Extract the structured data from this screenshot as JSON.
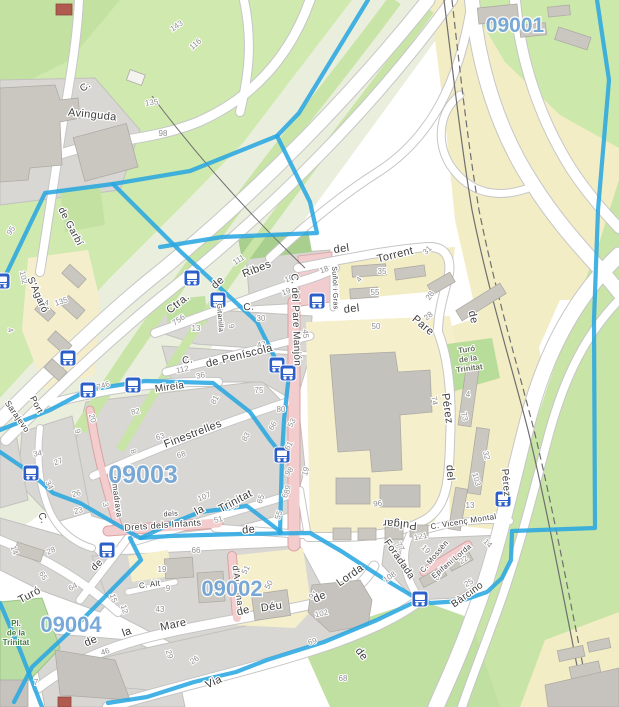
{
  "map": {
    "type": "openstreetmap-city-map",
    "area": "Trinitat Vella / Trinitat Nova (Barcelona)"
  },
  "colors": {
    "boundary": "#2aa7e0",
    "zone_label": "#74a6d6",
    "bus_icon": "#2c5fc8",
    "park_green": "#cfe9ae",
    "band_green": "#c8e4a6",
    "beige": "#f3edc5",
    "school_yellow": "#f6efcb",
    "block_gray": "#d8d7d3",
    "building_gray": "#cac7c1",
    "pink_road": "#f3cdcd",
    "street_text": "#3d3d3d",
    "housenumber_text": "#8e8e8e"
  },
  "zones": [
    {
      "label": "09001",
      "x": 515,
      "y": 32,
      "size": 21
    },
    {
      "label": "09003",
      "x": 143,
      "y": 483,
      "size": 25
    },
    {
      "label": "09002",
      "x": 232,
      "y": 596,
      "size": 22
    },
    {
      "label": "09004",
      "x": 71,
      "y": 632,
      "size": 22
    }
  ],
  "streets": [
    {
      "t": "Avinguda",
      "x": 92,
      "y": 118,
      "r": 6,
      "s": 11
    },
    {
      "t": "C.",
      "x": 87,
      "y": 89,
      "r": -35,
      "s": 10
    },
    {
      "t": "de Garbí",
      "x": 68,
      "y": 228,
      "r": 62,
      "s": 10
    },
    {
      "t": "S'Agaró",
      "x": 35,
      "y": 296,
      "r": 66,
      "s": 10
    },
    {
      "t": "Port",
      "x": 34,
      "y": 406,
      "r": 62,
      "s": 9
    },
    {
      "t": "Sarajevo",
      "x": 15,
      "y": 418,
      "r": 55,
      "s": 8.5
    },
    {
      "t": "Ctra.",
      "x": 180,
      "y": 306,
      "r": -38,
      "s": 11
    },
    {
      "t": "de",
      "x": 220,
      "y": 285,
      "r": -42,
      "s": 11
    },
    {
      "t": "Ribes",
      "x": 258,
      "y": 272,
      "r": -22,
      "s": 11
    },
    {
      "t": "del",
      "x": 342,
      "y": 252,
      "r": -8,
      "s": 11
    },
    {
      "t": "Torrent",
      "x": 396,
      "y": 258,
      "r": -14,
      "s": 11
    },
    {
      "t": "C.",
      "x": 249,
      "y": 310,
      "r": -4,
      "s": 10
    },
    {
      "t": "del",
      "x": 352,
      "y": 312,
      "r": -6,
      "s": 11
    },
    {
      "t": "Pare",
      "x": 421,
      "y": 328,
      "r": 40,
      "s": 11
    },
    {
      "t": "de",
      "x": 470,
      "y": 318,
      "r": 76,
      "s": 11
    },
    {
      "t": "Suñol i Gras",
      "x": 333,
      "y": 288,
      "r": 88,
      "s": 7
    },
    {
      "t": "Gitanilla",
      "x": 218,
      "y": 318,
      "r": 86,
      "s": 7
    },
    {
      "t": "de Peníscola",
      "x": 240,
      "y": 359,
      "r": -14,
      "s": 11
    },
    {
      "t": "C.",
      "x": 188,
      "y": 363,
      "r": -8,
      "s": 10
    },
    {
      "t": "Mireia",
      "x": 170,
      "y": 390,
      "r": -8,
      "s": 10
    },
    {
      "t": "Finestrelles",
      "x": 194,
      "y": 437,
      "r": -21,
      "s": 11
    },
    {
      "t": "C. del Pare Manjón",
      "x": 293,
      "y": 320,
      "r": 88,
      "s": 10
    },
    {
      "t": "Pérez",
      "x": 444,
      "y": 409,
      "r": 82,
      "s": 11
    },
    {
      "t": "del",
      "x": 447,
      "y": 473,
      "r": 86,
      "s": 11
    },
    {
      "t": "Pulgar",
      "x": 400,
      "y": 521,
      "r": 185,
      "s": 11
    },
    {
      "t": "Pérez",
      "x": 503,
      "y": 483,
      "r": 85,
      "s": 10
    },
    {
      "t": "la",
      "x": 201,
      "y": 513,
      "r": -28,
      "s": 11
    },
    {
      "t": "Trinitat",
      "x": 237,
      "y": 504,
      "r": -28,
      "s": 11
    },
    {
      "t": "C.",
      "x": 40,
      "y": 519,
      "r": 70,
      "s": 10
    },
    {
      "t": "Almadrava",
      "x": 114,
      "y": 497,
      "r": 82,
      "s": 8
    },
    {
      "t": "Turó",
      "x": 31,
      "y": 598,
      "r": -28,
      "s": 11
    },
    {
      "t": "de",
      "x": 99,
      "y": 567,
      "r": -45,
      "s": 10
    },
    {
      "t": "de",
      "x": 92,
      "y": 644,
      "r": -22,
      "s": 11
    },
    {
      "t": "la",
      "x": 128,
      "y": 635,
      "r": -20,
      "s": 11
    },
    {
      "t": "Mare",
      "x": 174,
      "y": 628,
      "r": -12,
      "s": 11
    },
    {
      "t": "de",
      "x": 244,
      "y": 614,
      "r": -15,
      "s": 11
    },
    {
      "t": "Déu",
      "x": 272,
      "y": 610,
      "r": -8,
      "s": 11
    },
    {
      "t": "de",
      "x": 321,
      "y": 600,
      "r": -25,
      "s": 11
    },
    {
      "t": "Lorda",
      "x": 352,
      "y": 578,
      "r": -35,
      "s": 11
    },
    {
      "t": "Foradada",
      "x": 397,
      "y": 561,
      "r": 55,
      "s": 10
    },
    {
      "t": "d'Ausona",
      "x": 235,
      "y": 586,
      "r": 83,
      "s": 9
    },
    {
      "t": "Drets dels Infants",
      "x": 163,
      "y": 528,
      "r": -4,
      "s": 9
    },
    {
      "t": "dels",
      "x": 171,
      "y": 516,
      "r": -4,
      "s": 7
    },
    {
      "t": "C. Alt",
      "x": 150,
      "y": 587,
      "r": -8,
      "s": 8
    },
    {
      "t": "de",
      "x": 249,
      "y": 533,
      "r": -6,
      "s": 11
    },
    {
      "t": "de",
      "x": 359,
      "y": 656,
      "r": 52,
      "s": 11
    },
    {
      "t": "Via",
      "x": 215,
      "y": 685,
      "r": -24,
      "s": 11
    },
    {
      "t": "C. Vicenç Montal",
      "x": 464,
      "y": 524,
      "r": -9,
      "s": 8
    },
    {
      "t": "C. Mossèn",
      "x": 436,
      "y": 558,
      "r": -50,
      "s": 7.5
    },
    {
      "t": "Epifani Lorda",
      "x": 453,
      "y": 563,
      "r": -40,
      "s": 7.5
    },
    {
      "t": "Bàrcino",
      "x": 469,
      "y": 597,
      "r": -36,
      "s": 10
    }
  ],
  "house_numbers": [
    {
      "t": "143",
      "x": 178,
      "y": 28,
      "r": -35
    },
    {
      "t": "116",
      "x": 197,
      "y": 46,
      "r": -40
    },
    {
      "t": "135",
      "x": 152,
      "y": 105,
      "r": -8
    },
    {
      "t": "98",
      "x": 163,
      "y": 136,
      "r": 0
    },
    {
      "t": "95",
      "x": 13,
      "y": 232,
      "r": -55
    },
    {
      "t": "102",
      "x": 21,
      "y": 278,
      "r": 78
    },
    {
      "t": "54",
      "x": 44,
      "y": 305,
      "r": 8
    },
    {
      "t": "135",
      "x": 62,
      "y": 304,
      "r": -18
    },
    {
      "t": "4",
      "x": 8,
      "y": 331,
      "r": 70
    },
    {
      "t": "111",
      "x": 240,
      "y": 262,
      "r": -32
    },
    {
      "t": "16",
      "x": 290,
      "y": 281,
      "r": -22
    },
    {
      "t": "19",
      "x": 287,
      "y": 294,
      "r": -22
    },
    {
      "t": "30",
      "x": 261,
      "y": 321,
      "r": 0
    },
    {
      "t": "9",
      "x": 229,
      "y": 327,
      "r": 72
    },
    {
      "t": "756",
      "x": 180,
      "y": 322,
      "r": -35
    },
    {
      "t": "13",
      "x": 196,
      "y": 331,
      "r": 0
    },
    {
      "t": "112",
      "x": 183,
      "y": 372,
      "r": -12
    },
    {
      "t": "36",
      "x": 201,
      "y": 378,
      "r": -12
    },
    {
      "t": "75",
      "x": 259,
      "y": 393,
      "r": 0
    },
    {
      "t": "18",
      "x": 325,
      "y": 272,
      "r": -20
    },
    {
      "t": "4",
      "x": 361,
      "y": 281,
      "r": -50
    },
    {
      "t": "35",
      "x": 382,
      "y": 274,
      "r": 0
    },
    {
      "t": "55",
      "x": 375,
      "y": 295,
      "r": 0
    },
    {
      "t": "28",
      "x": 432,
      "y": 297,
      "r": -55
    },
    {
      "t": "31",
      "x": 429,
      "y": 252,
      "r": -45
    },
    {
      "t": "50",
      "x": 376,
      "y": 329,
      "r": 0
    },
    {
      "t": "45",
      "x": 303,
      "y": 334,
      "r": 85
    },
    {
      "t": "43",
      "x": 262,
      "y": 347,
      "r": -12
    },
    {
      "t": "82",
      "x": 136,
      "y": 414,
      "r": -12
    },
    {
      "t": "746",
      "x": 104,
      "y": 388,
      "r": -18
    },
    {
      "t": "81",
      "x": 217,
      "y": 401,
      "r": -62
    },
    {
      "t": "80",
      "x": 281,
      "y": 412,
      "r": 0
    },
    {
      "t": "63",
      "x": 161,
      "y": 439,
      "r": -18
    },
    {
      "t": "68",
      "x": 182,
      "y": 457,
      "r": -18
    },
    {
      "t": "83",
      "x": 248,
      "y": 438,
      "r": -62
    },
    {
      "t": "66",
      "x": 275,
      "y": 427,
      "r": -62
    },
    {
      "t": "53",
      "x": 294,
      "y": 424,
      "r": -62
    },
    {
      "t": "61",
      "x": 291,
      "y": 447,
      "r": -62
    },
    {
      "t": "20",
      "x": 90,
      "y": 419,
      "r": 72
    },
    {
      "t": "9",
      "x": 75,
      "y": 432,
      "r": 72
    },
    {
      "t": "34",
      "x": 38,
      "y": 456,
      "r": -10
    },
    {
      "t": "27",
      "x": 59,
      "y": 464,
      "r": -20
    },
    {
      "t": "26",
      "x": 77,
      "y": 496,
      "r": -15
    },
    {
      "t": "23",
      "x": 79,
      "y": 513,
      "r": -15
    },
    {
      "t": "3",
      "x": 103,
      "y": 505,
      "r": 80
    },
    {
      "t": "8",
      "x": 131,
      "y": 452,
      "r": 75
    },
    {
      "t": "98",
      "x": 291,
      "y": 473,
      "r": -50
    },
    {
      "t": "19",
      "x": 308,
      "y": 472,
      "r": -75
    },
    {
      "t": "68",
      "x": 288,
      "y": 494,
      "r": -75
    },
    {
      "t": "65",
      "x": 263,
      "y": 500,
      "r": -70
    },
    {
      "t": "55",
      "x": 281,
      "y": 516,
      "r": -70
    },
    {
      "t": "89",
      "x": 290,
      "y": 490,
      "r": -80
    },
    {
      "t": "107",
      "x": 205,
      "y": 499,
      "r": -22
    },
    {
      "t": "90",
      "x": 235,
      "y": 508,
      "r": -22
    },
    {
      "t": "51",
      "x": 219,
      "y": 522,
      "r": -15
    },
    {
      "t": "66",
      "x": 196,
      "y": 553,
      "r": 0
    },
    {
      "t": "64",
      "x": 74,
      "y": 589,
      "r": -28
    },
    {
      "t": "65",
      "x": 41,
      "y": 577,
      "r": 60
    },
    {
      "t": "28",
      "x": 52,
      "y": 553,
      "r": -25
    },
    {
      "t": "14",
      "x": 12,
      "y": 551,
      "r": 70
    },
    {
      "t": "15",
      "x": 111,
      "y": 599,
      "r": 72
    },
    {
      "t": "12",
      "x": 122,
      "y": 610,
      "r": 72
    },
    {
      "t": "19",
      "x": 162,
      "y": 572,
      "r": 0
    },
    {
      "t": "9",
      "x": 168,
      "y": 591,
      "r": 0
    },
    {
      "t": "43",
      "x": 160,
      "y": 612,
      "r": 0
    },
    {
      "t": "46",
      "x": 106,
      "y": 654,
      "r": -20
    },
    {
      "t": "29",
      "x": 167,
      "y": 655,
      "r": 72
    },
    {
      "t": "26",
      "x": 196,
      "y": 662,
      "r": -35
    },
    {
      "t": "7",
      "x": 36,
      "y": 685,
      "r": 0
    },
    {
      "t": "34",
      "x": 47,
      "y": 486,
      "r": 65
    },
    {
      "t": "50",
      "x": 271,
      "y": 586,
      "r": -62
    },
    {
      "t": "51",
      "x": 248,
      "y": 571,
      "r": -62
    },
    {
      "t": "91",
      "x": 315,
      "y": 597,
      "r": -40
    },
    {
      "t": "102",
      "x": 322,
      "y": 616,
      "r": -12
    },
    {
      "t": "108",
      "x": 391,
      "y": 579,
      "r": -35
    },
    {
      "t": "69",
      "x": 313,
      "y": 644,
      "r": -15
    },
    {
      "t": "68",
      "x": 343,
      "y": 681,
      "r": 0
    },
    {
      "t": "77",
      "x": 398,
      "y": 548,
      "r": 60
    },
    {
      "t": "19",
      "x": 424,
      "y": 551,
      "r": 45
    },
    {
      "t": "14",
      "x": 486,
      "y": 545,
      "r": 45
    },
    {
      "t": "22",
      "x": 465,
      "y": 562,
      "r": -35
    },
    {
      "t": "89",
      "x": 440,
      "y": 577,
      "r": -62
    },
    {
      "t": "25",
      "x": 470,
      "y": 585,
      "r": -30
    },
    {
      "t": "121",
      "x": 421,
      "y": 539,
      "r": -10
    },
    {
      "t": "74",
      "x": 432,
      "y": 401,
      "r": 80
    },
    {
      "t": "73",
      "x": 462,
      "y": 417,
      "r": 75
    },
    {
      "t": "4",
      "x": 468,
      "y": 397,
      "r": 0
    },
    {
      "t": "32",
      "x": 484,
      "y": 456,
      "r": 75
    },
    {
      "t": "103",
      "x": 474,
      "y": 480,
      "r": 75
    },
    {
      "t": "13",
      "x": 470,
      "y": 508,
      "r": 0
    },
    {
      "t": "28",
      "x": 430,
      "y": 318,
      "r": -40
    },
    {
      "t": "96",
      "x": 378,
      "y": 506,
      "r": -8
    }
  ],
  "places": [
    {
      "lines": [
        "Turó",
        "de la",
        "Trinitat"
      ],
      "x": 467,
      "y": 352,
      "r": -8,
      "s": 8,
      "color": "#66705a"
    },
    {
      "lines": [
        "Pl.",
        "de la",
        "Trinitat"
      ],
      "x": 16,
      "y": 626,
      "r": 0,
      "s": 8,
      "color": "#3f7a3f"
    }
  ],
  "bus_stops": [
    [
      2,
      281
    ],
    [
      192,
      278
    ],
    [
      218,
      300
    ],
    [
      317,
      301
    ],
    [
      277,
      365
    ],
    [
      288,
      373
    ],
    [
      68,
      358
    ],
    [
      88,
      390
    ],
    [
      133,
      385
    ],
    [
      31,
      473
    ],
    [
      282,
      455
    ],
    [
      107,
      550
    ],
    [
      420,
      599
    ],
    [
      503,
      499
    ]
  ],
  "boundaries": [
    "368,0 299,113 277,136 190,171 113,184 45,193 0,287",
    "277,136 310,202 317,233 222,237 160,247",
    "113,184 180,251 257,322 277,362 289,374 284,420 282,455 280,533",
    "0,430 50,410 88,390 145,381 213,383 250,412 270,440 282,455",
    "597,0 609,80 598,210 594,320 595,528 512,531 511,560 502,578 487,592 461,601 431,603 419,600 377,620 324,642 267,660 236,672 194,682 147,697 108,703",
    "0,452 31,473 53,493 80,503 140,538 170,536 240,534 310,533 341,551 381,577 419,600",
    "130,538 141,560 80,622 32,667 14,702",
    "0,603 20,650 42,707",
    "281,532 247,506 200,512 170,524 141,538"
  ]
}
